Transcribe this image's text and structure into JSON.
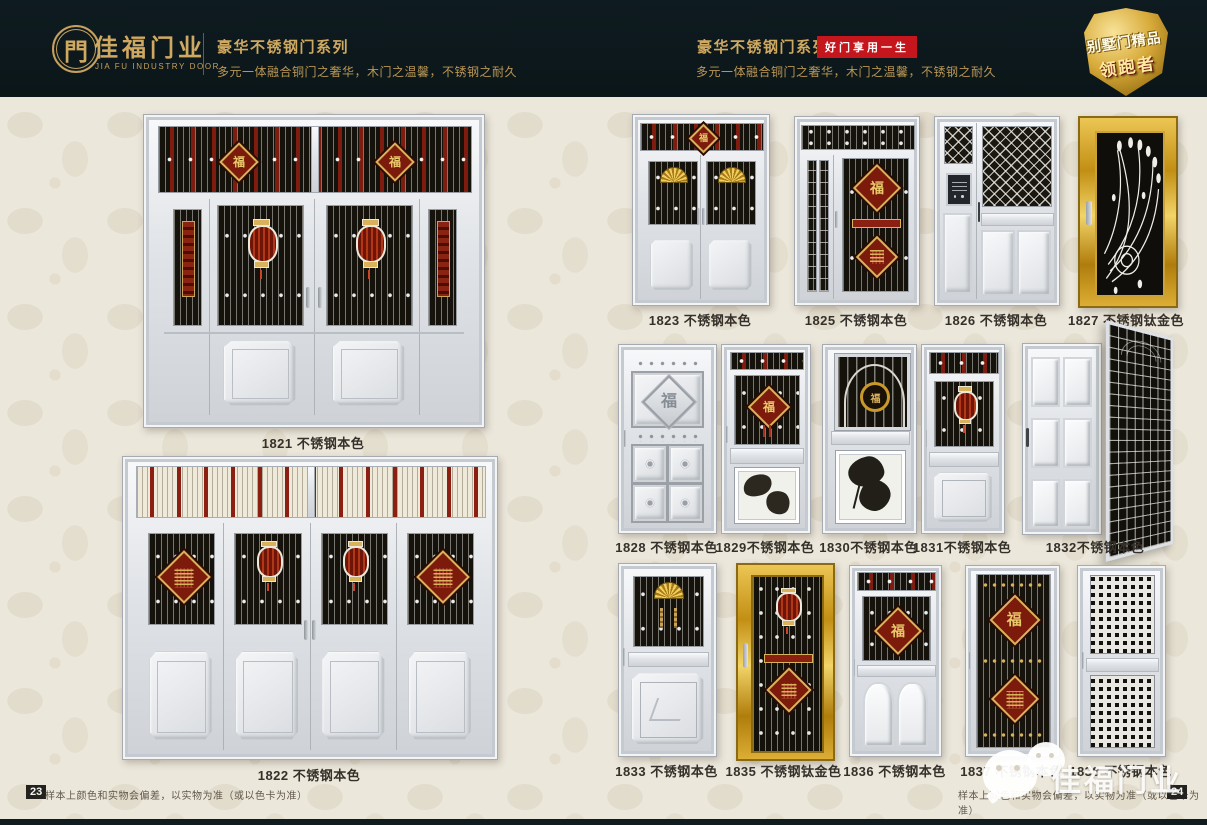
{
  "header": {
    "brand": {
      "logo_glyph": "門",
      "name": "佳福门业",
      "name_en": "JIA FU INDUSTRY DOOR"
    },
    "series_left": {
      "title": "豪华不锈钢门系列",
      "tagline": "多元一体融合铜门之奢华，木门之温馨，不锈钢之耐久"
    },
    "series_right": {
      "title": "豪华不锈钢门系列",
      "badge": "好门享用一生",
      "tagline": "多元一体融合铜门之奢华，木门之温馨，不锈钢之耐久"
    },
    "shield": {
      "line1": "别墅门精品",
      "line2": "领跑者"
    }
  },
  "doors": [
    {
      "id": "1821",
      "label": "1821 不锈钢本色",
      "variant": "quad-lantern"
    },
    {
      "id": "1822",
      "label": "1822 不锈钢本色",
      "variant": "quad-knot"
    },
    {
      "id": "1823",
      "label": "1823 不锈钢本色",
      "variant": "double-fan"
    },
    {
      "id": "1825",
      "label": "1825 不锈钢本色",
      "variant": "mother-son-fu"
    },
    {
      "id": "1826",
      "label": "1826 不锈钢本色",
      "variant": "mother-son-intercom"
    },
    {
      "id": "1827",
      "label": "1827 不锈钢钛金色",
      "variant": "gold-peacock"
    },
    {
      "id": "1828",
      "label": "1828 不锈钢本色",
      "variant": "single-panels"
    },
    {
      "id": "1829",
      "label": "1829不锈钢本色",
      "variant": "grille-etch"
    },
    {
      "id": "1830",
      "label": "1830不锈钢本色",
      "variant": "arch-grille"
    },
    {
      "id": "1831",
      "label": "1831不锈钢本色",
      "variant": "single-lantern"
    },
    {
      "id": "1832",
      "label": "1832不锈钢本色",
      "variant": "open-door"
    },
    {
      "id": "1833",
      "label": "1833 不锈钢本色",
      "variant": "single-fan"
    },
    {
      "id": "1835",
      "label": "1835 不锈钢钛金色",
      "variant": "gold-full-grille"
    },
    {
      "id": "1836",
      "label": "1836 不锈钢本色",
      "variant": "fu-diamond"
    },
    {
      "id": "1837",
      "label": "1837 不锈钢本色",
      "variant": "two-diamond"
    },
    {
      "id": "1838",
      "label": "1838 不锈钢本色",
      "variant": "mesh"
    }
  ],
  "ornaments": {
    "fu_character": "福"
  },
  "footer_left": {
    "page_number": "23",
    "disclaimer": "样本上颜色和实物会偏差，以实物为准（或以色卡为准）"
  },
  "footer_right": {
    "page_number": "24",
    "disclaimer": "样本上颜色和实物会偏差，以实物为准（或以色卡为准）"
  },
  "watermark": {
    "text": "佳福门业"
  },
  "colors": {
    "header_bg": "#0d191d",
    "gold_text": "#cfa961",
    "badge_red": "#c4161c",
    "page_bg": "#ece7db",
    "label_text": "#35302a",
    "grille_black": "#16130d",
    "ornament_red": "#7c1a0c",
    "titanium_gold": "#c89018"
  }
}
